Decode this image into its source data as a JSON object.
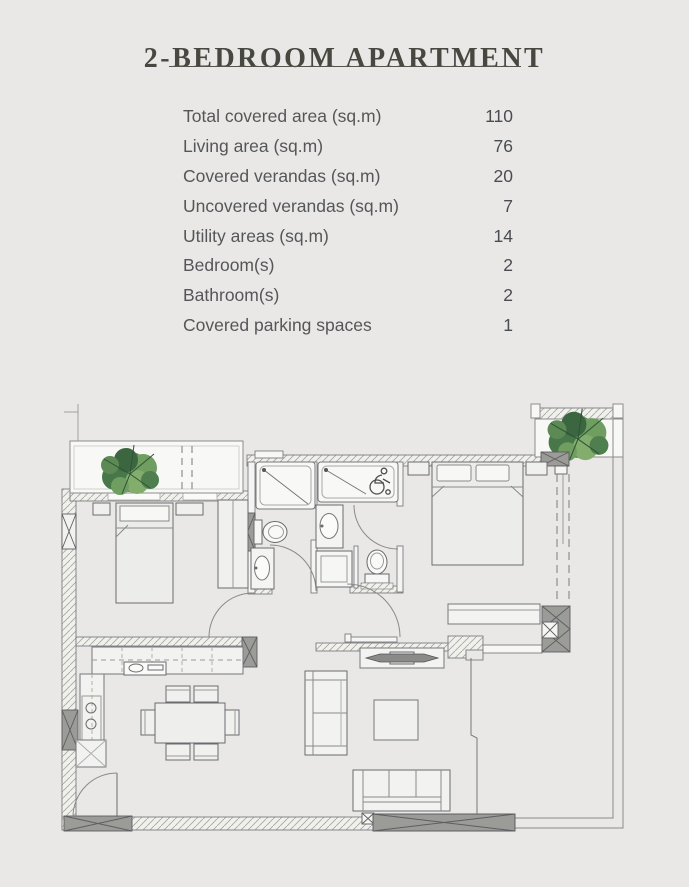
{
  "header": {
    "title": "2-BEDROOM APARTMENT"
  },
  "specs": {
    "rows": [
      {
        "label": "Total covered area (sq.m)",
        "value": "110"
      },
      {
        "label": "Living area (sq.m)",
        "value": "76"
      },
      {
        "label": "Covered verandas (sq.m)",
        "value": "20"
      },
      {
        "label": "Uncovered verandas (sq.m)",
        "value": "7"
      },
      {
        "label": "Utility areas (sq.m)",
        "value": "14"
      },
      {
        "label": "Bedroom(s)",
        "value": "2"
      },
      {
        "label": "Bathroom(s)",
        "value": "2"
      },
      {
        "label": "Covered parking spaces",
        "value": "1"
      }
    ]
  },
  "floor_plan": {
    "type": "architectural-floor-plan",
    "elements": [
      "planter-balcony-left",
      "planter-balcony-right",
      "bedroom-1-bed",
      "wardrobe",
      "bathroom-1-shower",
      "bathroom-1-toilet",
      "bathroom-1-sink",
      "bathroom-2-shower",
      "accessible-shower-symbol",
      "bathroom-2-sink",
      "bathroom-2-toilet",
      "washing-machine",
      "bedroom-2-bed",
      "kitchen-counter",
      "kitchen-sink",
      "dining-table",
      "dining-chairs",
      "sofa",
      "coffee-table",
      "tv-console",
      "lounge-sofa",
      "entrance-door",
      "sliding-door",
      "veranda",
      "structural-columns"
    ],
    "colors": {
      "background": "#e9e8e6",
      "title": "#474941",
      "text": "#55565a",
      "wall_line": "#7d7d82",
      "furniture_line": "#6b6b6f",
      "column_fill": "#9b9b97",
      "plant_dark": "#3c663f",
      "plant_light": "#82ad6c"
    }
  }
}
